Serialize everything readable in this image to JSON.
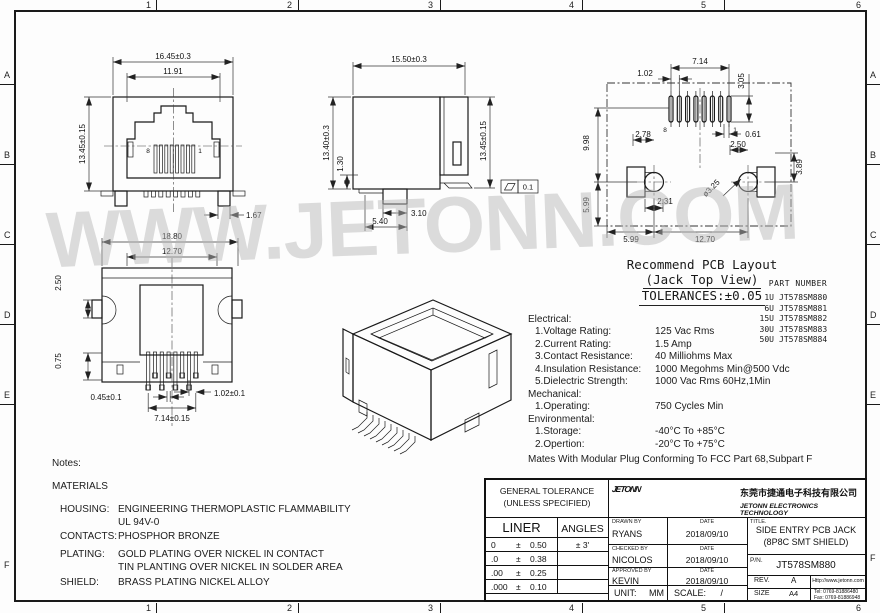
{
  "frame": {
    "columns": [
      "1",
      "2",
      "3",
      "4",
      "5",
      "6"
    ],
    "rows": [
      "A",
      "B",
      "C",
      "D",
      "E",
      "F"
    ]
  },
  "watermark": "WWW.JETONN.COM",
  "front_view": {
    "dim_overall_width": "16.45±0.3",
    "dim_opening_width": "11.91",
    "dim_overall_height": "13.45±0.15",
    "dim_foot_width": "1.67",
    "pin_left": "8",
    "pin_right": "1"
  },
  "side_view": {
    "dim_depth": "15.50±0.3",
    "dim_body_height": "13.40±0.3",
    "dim_standoff": "1.30",
    "dim_overall_height": "13.45±0.15",
    "dim_post_width": "3.10",
    "dim_post_offset": "5.40",
    "flatness_value": "0.1"
  },
  "top_view": {
    "dim_overall_width": "18.80",
    "dim_body_width": "12.70",
    "dim_ear": "2.50",
    "dim_pin_length": "0.75",
    "dim_pin_width": "0.45±0.1",
    "dim_pin_row_span": "7.14±0.15",
    "dim_pin_pitch": "1.02±0.1"
  },
  "pcb_layout": {
    "title_line1": "Recommend PCB Layout",
    "title_line2": "(Jack Top View)",
    "title_line3": "TOLERANCES:±0.05",
    "pin_left": "8",
    "pin_right": "1",
    "dim_pad_pitch": "1.02",
    "dim_pad_span": "7.14",
    "dim_pad_length": "3.05",
    "dim_pad_offset": "0.61",
    "dim_row_to_holes": "9.98",
    "dim_hole_to_edge_v": "5.99",
    "dim_left_hole_x": "2.78",
    "dim_right_hole_x": "2.50",
    "dim_right_side_v": "3.89",
    "dim_slot": "2.31",
    "dim_hole_dia": "ø3.25",
    "dim_edge_to_hole": "5.99",
    "dim_hole_span": "12.70"
  },
  "part_list": {
    "header": "PART NUMBER",
    "rows": [
      {
        "qty": "1U",
        "pn": "JT578SM880"
      },
      {
        "qty": "6U",
        "pn": "JT578SM881"
      },
      {
        "qty": "15U",
        "pn": "JT578SM882"
      },
      {
        "qty": "30U",
        "pn": "JT578SM883"
      },
      {
        "qty": "50U",
        "pn": "JT578SM884"
      }
    ]
  },
  "specs": {
    "rows": [
      {
        "label": "Electrical:",
        "value": ""
      },
      {
        "label": "1.Voltage Rating:",
        "value": "125 Vac Rms"
      },
      {
        "label": "2.Current Rating:",
        "value": "1.5 Amp"
      },
      {
        "label": "3.Contact Resistance:",
        "value": "40 Milliohms Max"
      },
      {
        "label": "4.Insulation Resistance:",
        "value": "1000 Megohms Min@500 Vdc"
      },
      {
        "label": "5.Dielectric Strength:",
        "value": "1000 Vac Rms 60Hz,1Min"
      },
      {
        "label": "Mechanical:",
        "value": ""
      },
      {
        "label": "1.Operating:",
        "value": "750 Cycles Min"
      },
      {
        "label": "Environmental:",
        "value": ""
      },
      {
        "label": "1.Storage:",
        "value": "-40°C To +85°C"
      },
      {
        "label": "2.Opertion:",
        "value": "-20°C To +75°C"
      }
    ],
    "footnote": "Mates With Modular Plug Conforming To FCC Part 68,Subpart F"
  },
  "notes": {
    "title": "Notes:",
    "subtitle": "MATERIALS",
    "rows": [
      {
        "label": "HOUSING:",
        "lines": [
          "ENGINEERING THERMOPLASTIC FLAMMABILITY",
          "UL 94V-0"
        ]
      },
      {
        "label": "CONTACTS:",
        "lines": [
          "PHOSPHOR BRONZE"
        ]
      },
      {
        "label": "PLATING:",
        "lines": [
          "GOLD PLATING OVER NICKEL IN CONTACT",
          "TIN PLANTING OVER NICKEL IN SOLDER AREA"
        ]
      },
      {
        "label": "SHIELD:",
        "lines": [
          "BRASS PLATING NICKEL ALLOY"
        ]
      }
    ]
  },
  "title_block": {
    "tolerance": {
      "header_line1": "GENERAL TOLERANCE",
      "header_line2": "(UNLESS SPECIFIED)",
      "col1": "LINER",
      "col2": "ANGLES",
      "rows": [
        {
          "prefix": "0",
          "pm": "±",
          "value": "0.50",
          "angle": "± 3'"
        },
        {
          "prefix": ".0",
          "pm": "±",
          "value": "0.38",
          "angle": ""
        },
        {
          "prefix": ".00",
          "pm": "±",
          "value": "0.25",
          "angle": ""
        },
        {
          "prefix": ".000",
          "pm": "±",
          "value": "0.10",
          "angle": ""
        }
      ]
    },
    "logo_text": "JETONN",
    "company_cn": "东莞市捷通电子科技有限公司",
    "company_en": "JETONN ELECTRONICS TECHNOLOGY",
    "sign_rows": [
      {
        "caption": "DRAWN BY",
        "name": "RYANS",
        "date_caption": "DATE",
        "date": "2018/09/10"
      },
      {
        "caption": "CHECKED BY",
        "name": "NICOLOS",
        "date_caption": "DATE",
        "date": "2018/09/10"
      },
      {
        "caption": "APPROVED BY",
        "name": "KEVIN",
        "date_caption": "DATE",
        "date": "2018/09/10"
      }
    ],
    "unit_label": "UNIT:",
    "unit_value": "MM",
    "scale_label": "SCALE:",
    "scale_value": "/",
    "title_caption": "TITLE.",
    "title_line1": "SIDE ENTRY PCB JACK",
    "title_line2": "(8P8C SMT SHIELD)",
    "pn_caption": "P/N.",
    "pn_value": "JT578SM880",
    "rev_caption": "REV.",
    "rev_value": "A",
    "size_caption": "SIZE",
    "size_value": "A4",
    "website": "Http://www.jetonn.com",
    "tel": "Tel:  0769-81886480",
    "fax": "Fax:  0769-81886948"
  }
}
